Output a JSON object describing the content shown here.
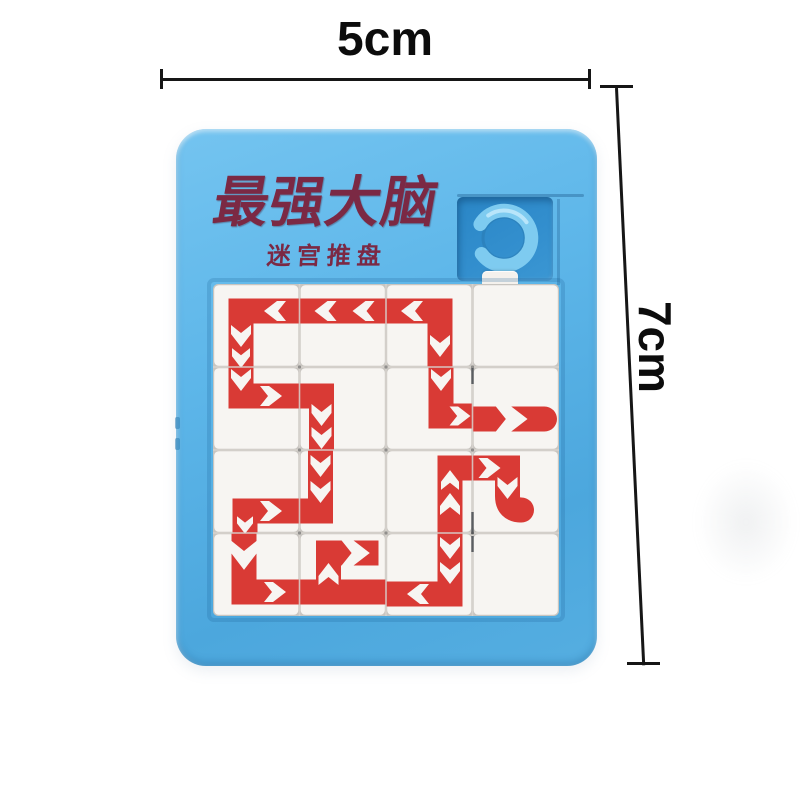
{
  "annotations": {
    "width_label": "5cm",
    "height_label": "7cm"
  },
  "toy": {
    "title": "最强大脑",
    "subtitle": "迷宫推盘",
    "colors": {
      "frame": "#58b2e6",
      "frame_dark": "#3a92c8",
      "recess": "#2f8ecd",
      "ring": "#7ecbf0",
      "ring_highlight": "#c2eafc",
      "tile": "#f7f5f2",
      "seam": "#c8c5c0",
      "seam_light": "#d8d4cf",
      "path_red": "#d93a35",
      "title_color": "#7b2944",
      "dimension_line": "#161616"
    },
    "maze": {
      "cols": 4,
      "rows": 4,
      "tile_w": 86.5,
      "tile_h": 83,
      "band_width": 25,
      "arrow_shape": "M-11 -10 L-2 -10 L11 0 L-2 10 L-11 10 L-3 0 Z",
      "tiles": [
        {
          "r": 1,
          "c": 1,
          "d": "M86.5 27 L28 27 L28 83",
          "arrows": [
            [
              62,
              27,
              180,
              1
            ],
            [
              28,
              52,
              90,
              1
            ],
            [
              28,
              74,
              90,
              0.9
            ]
          ]
        },
        {
          "r": 1,
          "c": 2,
          "d": "M0 27 L86.5 27",
          "arrows": [
            [
              26,
              27,
              180,
              1
            ],
            [
              64,
              27,
              180,
              1
            ]
          ]
        },
        {
          "r": 1,
          "c": 3,
          "d": "M0 27 L54 27 L54 83",
          "arrows": [
            [
              26,
              27,
              180,
              1
            ],
            [
              54,
              62,
              90,
              1
            ]
          ]
        },
        {
          "r": 2,
          "c": 1,
          "d": "M28 0 L28 29 L86.5 29",
          "arrows": [
            [
              28,
              13,
              90,
              1
            ],
            [
              58,
              29,
              0,
              1
            ]
          ]
        },
        {
          "r": 2,
          "c": 2,
          "d": "M0 29 L22 29 L22 83",
          "arrows": [
            [
              22,
              48,
              90,
              1
            ],
            [
              22,
              71,
              90,
              1
            ]
          ]
        },
        {
          "r": 2,
          "c": 3,
          "d": "M55 0 L55 49 L86.5 49",
          "arrows": [
            [
              55,
              13,
              90,
              1
            ],
            [
              74,
              49,
              0,
              0.95
            ]
          ]
        },
        {
          "r": 2,
          "c": 4,
          "d": "M0 52 L72 52",
          "dots": [
            [
              72,
              52
            ]
          ],
          "arrows": [
            [
              38,
              52,
              0,
              1.55
            ]
          ]
        },
        {
          "r": 3,
          "c": 1,
          "d": "M86.5 61 L32 61 L32 83",
          "arrows": [
            [
              58,
              61,
              0,
              1
            ],
            [
              32,
              75,
              90,
              0.8
            ]
          ]
        },
        {
          "r": 3,
          "c": 2,
          "d": "M21 0 L21 61 L0 61",
          "arrows": [
            [
              21,
              16,
              90,
              1
            ],
            [
              21,
              42,
              90,
              1
            ]
          ]
        },
        {
          "r": 3,
          "c": 3,
          "d": "M64 83 L64 18 L86.5 18",
          "arrows": [
            [
              64,
              54,
              -90,
              1
            ],
            [
              64,
              30,
              -90,
              0.9
            ]
          ]
        },
        {
          "r": 3,
          "c": 4,
          "d": "M0 18 L35 18 L35 46 Q35 60 49 60",
          "dots": [
            [
              49,
              60
            ]
          ],
          "arrows": [
            [
              17,
              18,
              0,
              1
            ],
            [
              35,
              38,
              90,
              1
            ]
          ]
        },
        {
          "r": 4,
          "c": 1,
          "d": "M31 0 L31 59 L86.5 59",
          "arrows": [
            [
              31,
              22,
              90,
              1.35
            ],
            [
              62,
              59,
              0,
              1
            ]
          ]
        },
        {
          "r": 4,
          "c": 2,
          "d": "M0 59 L86.5 59 M29 59 L29 20 L79 20",
          "arrows": [
            [
              29,
              41,
              -90,
              1
            ],
            [
              56,
              20,
              0,
              1.3
            ]
          ]
        },
        {
          "r": 4,
          "c": 3,
          "d": "M64 0 L64 61 L0 61",
          "arrows": [
            [
              64,
              15,
              90,
              1
            ],
            [
              64,
              40,
              90,
              1
            ],
            [
              32,
              61,
              180,
              1
            ]
          ]
        }
      ],
      "marks": {
        "dashes": [
          [
            259.5,
            84,
            16
          ],
          [
            259.5,
            228,
            22
          ],
          [
            259.5,
            252,
            16
          ]
        ],
        "dots": [
          [
            86.5,
            83
          ],
          [
            173,
            83
          ],
          [
            259.5,
            83
          ],
          [
            86.5,
            166
          ],
          [
            173,
            166
          ],
          [
            259.5,
            166
          ],
          [
            86.5,
            249
          ],
          [
            173,
            249
          ],
          [
            259.5,
            249
          ]
        ]
      }
    }
  }
}
